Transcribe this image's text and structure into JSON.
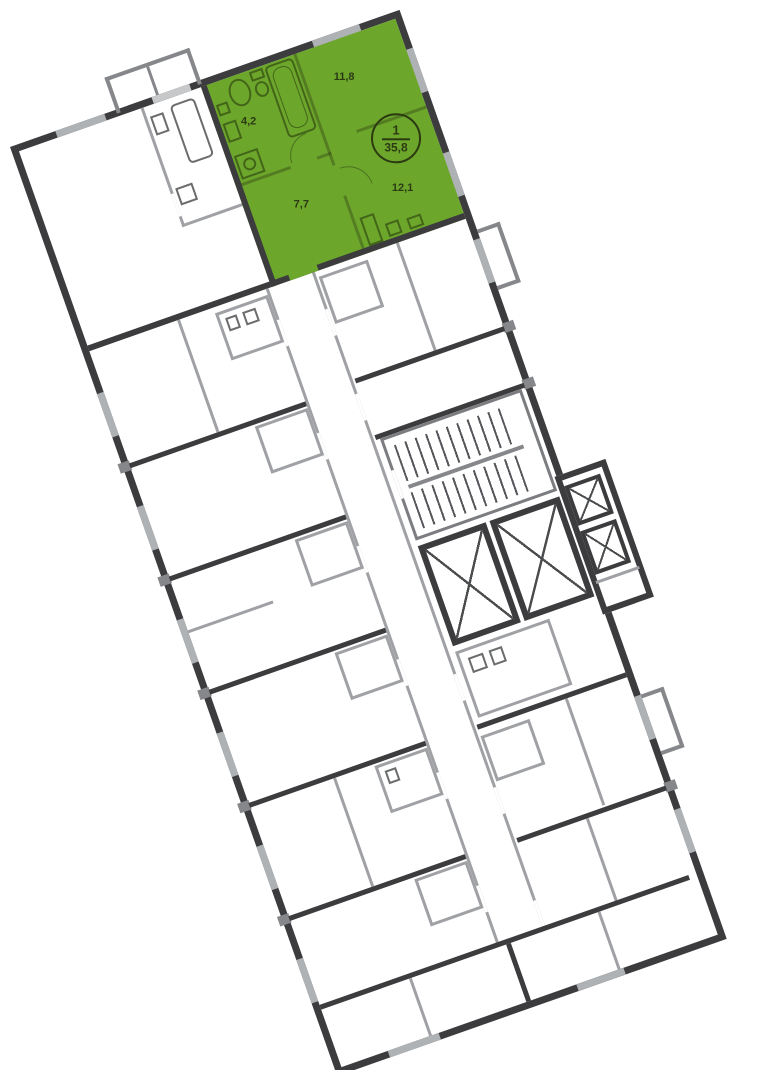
{
  "plan": {
    "rotation_deg": -19.4,
    "colors": {
      "bg": "#FFFFFF",
      "unit-fill": "#6CA72C",
      "unit-ink": "#2C3A12",
      "wall-dark": "#3C3C3E",
      "wall-light": "#9FA1A4",
      "wall-mid": "#85878A",
      "window": "#AFB2B5",
      "fixture": "#6A6C6E"
    },
    "highlighted_unit": {
      "badge": {
        "number": "1",
        "total_area": "35,8"
      },
      "rooms": {
        "living": {
          "area": "11,8"
        },
        "bathroom": {
          "area": "4,2"
        },
        "hallway": {
          "area": "7,7"
        },
        "kitchen_room": {
          "area": "12,1"
        }
      }
    }
  }
}
